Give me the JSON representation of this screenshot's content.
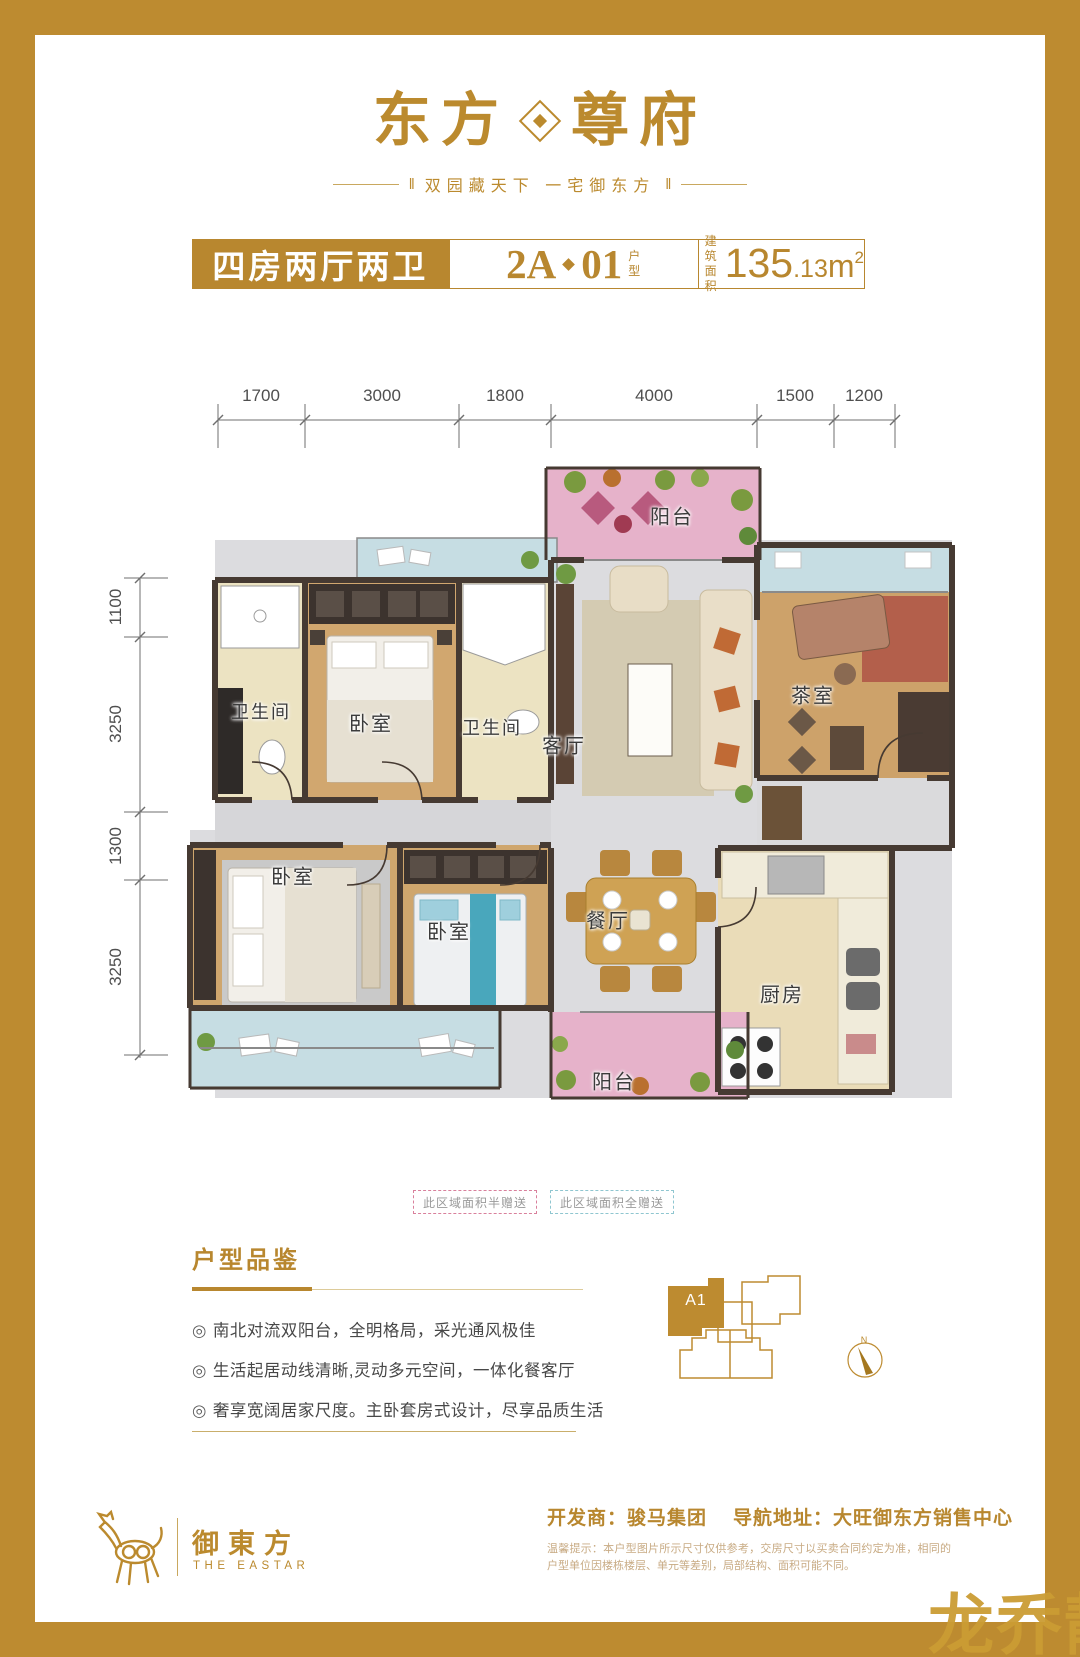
{
  "brand": {
    "logo_left": "东方",
    "logo_right": "尊府",
    "tagline": "双园藏天下  一宅御东方",
    "tagline_bars": "‖"
  },
  "title_bar": {
    "rooms_label": "四房两厅两卫",
    "unit_code_a": "2A",
    "unit_code_b": "01",
    "unit_suffix_top": "户",
    "unit_suffix_bottom": "型",
    "area_prefix_top": "建筑",
    "area_prefix_bottom": "面积",
    "area_int": "135",
    "area_dec": ".13",
    "area_unit": "m",
    "area_sup": "2"
  },
  "dimensions": {
    "top": [
      "1700",
      "3000",
      "1800",
      "4000",
      "1500",
      "1200"
    ],
    "left": [
      "1100",
      "3250",
      "1300",
      "3250"
    ]
  },
  "floorplan": {
    "rooms": [
      {
        "id": "balcony-north",
        "label": "阳台"
      },
      {
        "id": "bathroom-1",
        "label": "卫生间"
      },
      {
        "id": "bedroom-1",
        "label": "卧室"
      },
      {
        "id": "bathroom-2",
        "label": "卫生间"
      },
      {
        "id": "living-room",
        "label": "客厅"
      },
      {
        "id": "tea-room",
        "label": "茶室"
      },
      {
        "id": "bedroom-2",
        "label": "卧室"
      },
      {
        "id": "bedroom-3",
        "label": "卧室"
      },
      {
        "id": "dining-room",
        "label": "餐厅"
      },
      {
        "id": "kitchen",
        "label": "厨房"
      },
      {
        "id": "balcony-south",
        "label": "阳台"
      }
    ]
  },
  "legend": {
    "half_gift": "此区域面积半赠送",
    "full_gift": "此区域面积全赠送"
  },
  "review": {
    "heading": "户型品鉴",
    "bullet_marker": "◎",
    "bullets": [
      "南北对流双阳台，全明格局，采光通风极佳",
      "生活起居动线清晰,灵动多元空间，一体化餐客厅",
      "奢享宽阔居家尺度。主卧套房式设计，尽享品质生活"
    ]
  },
  "keyplan": {
    "unit_tag": "A1",
    "compass_north": "N"
  },
  "footer": {
    "logo_cn": "御東方",
    "logo_en": "THE EASTAR",
    "developer": "开发商：骏马集团",
    "address": "导航地址：大旺御东方销售中心",
    "disclaimer": "温馨提示：本户型图片所示尺寸仅供参考，交房尺寸以买卖合同约定为准，相同的户型单位因楼栋楼层、单元等差别，局部结构、面积可能不同。"
  },
  "watermark": "龙乔靓居",
  "colors": {
    "accent_gold": "#bd8b30",
    "wall_dark": "#463a32",
    "balcony_pink": "#e6b2ca",
    "bay_blue": "#c6dde3",
    "wood_floor": "#cfa66d",
    "tile_beige": "#ece3c2",
    "marble_gray": "#dcdcdf",
    "legend_half_border": "#d9809c",
    "legend_full_border": "#8fc6d0"
  }
}
